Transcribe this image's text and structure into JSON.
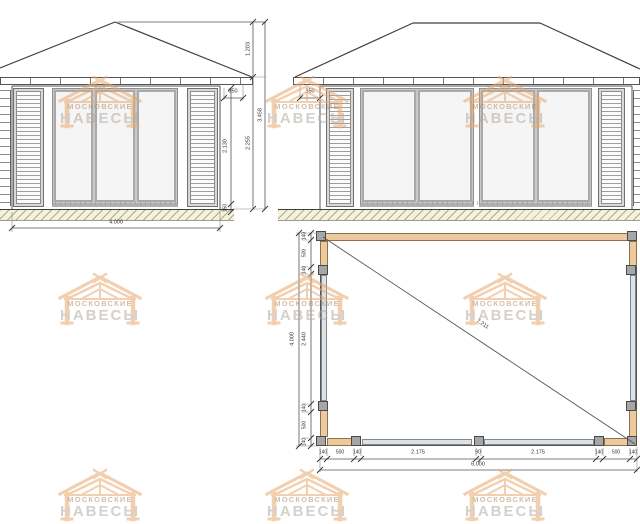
{
  "watermark": {
    "line1": "МОСКОВСКИЕ",
    "line2": "НАВЕСЫ"
  },
  "front_elevation": {
    "dims": {
      "eave_overhang": "350",
      "door_height": "2.130",
      "base_height": "150",
      "wall_height": "2.255",
      "roof_height": "1.203",
      "total_height": "3.458",
      "width": "4.000"
    }
  },
  "side_elevation": {
    "dims": {
      "eave_overhang": "350"
    }
  },
  "plan": {
    "dims_bottom": [
      "140",
      "500",
      "140",
      "2.175",
      "90",
      "2.175",
      "140",
      "500",
      "140"
    ],
    "bottom_total": "6.000",
    "dims_left": [
      "140",
      "500",
      "140",
      "2.440",
      "140",
      "500",
      "140"
    ],
    "left_total": "4.000",
    "diagonal": "7.211"
  },
  "colors": {
    "wood_beam": "#ecca9e",
    "watermark_orange": "#e8a96e",
    "ground_hatch_bg": "#f5f2da",
    "line": "#444444",
    "panel_gray": "#d8d8d8"
  }
}
